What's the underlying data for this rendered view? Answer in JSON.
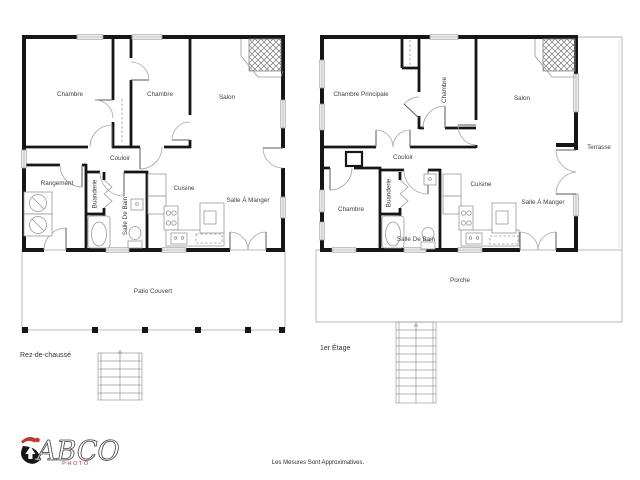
{
  "colors": {
    "wall": "#161616",
    "thin_line": "#9a9a9a",
    "label_text": "#3f3f3f",
    "logo_red": "#c8362a",
    "background": "#ffffff"
  },
  "ground_floor": {
    "floor_label": "Rez-de-chaussé",
    "rooms": {
      "chambre_left": "Chambre",
      "chambre_mid": "Chambre",
      "salon": "Salon",
      "couloir": "Couloir",
      "rangement": "Rangement",
      "buanderie": "Buanderie",
      "salle_de_bain": "Salle De Bain",
      "cuisine": "Cuisine",
      "salle_a_manger": "Salle À Manger",
      "patio": "Patio Couvert"
    }
  },
  "first_floor": {
    "floor_label": "1er Étage",
    "rooms": {
      "chambre_principale": "Chambre Principale",
      "chambre_top": "Chambre",
      "salon": "Salon",
      "terrasse": "Terrasse",
      "couloir": "Couloir",
      "chambre_bottom": "Chambre",
      "buanderie": "Buanderie",
      "salle_de_bain": "Salle De Bain",
      "cuisine": "Cuisine",
      "salle_a_manger": "Salle À Manger",
      "porche": "Porche"
    }
  },
  "footer": {
    "logo_name": "ABCO",
    "logo_sub": "PHOTO",
    "disclaimer": "Les Mesures Sont Approximatives."
  }
}
